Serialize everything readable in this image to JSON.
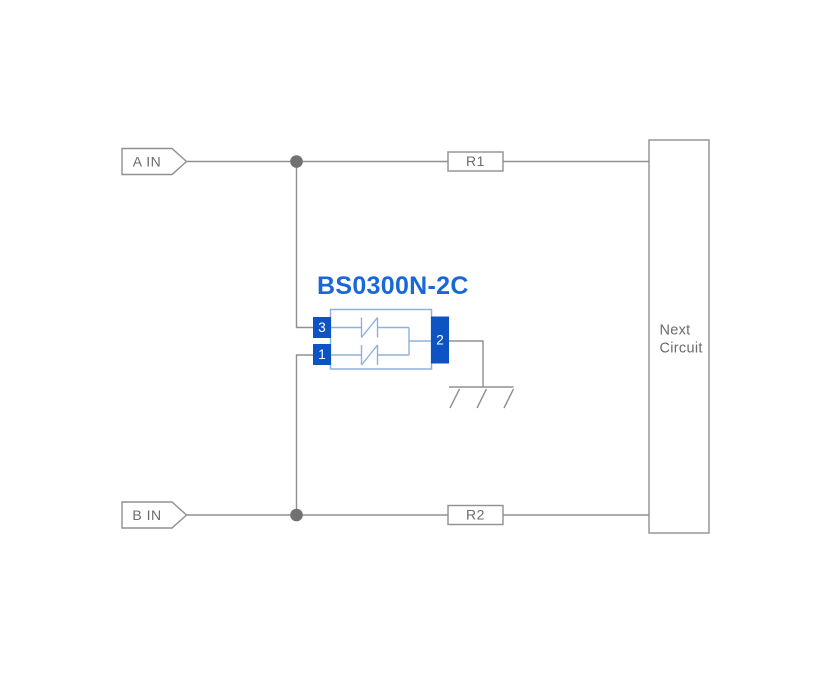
{
  "labels": {
    "input_a": "A IN",
    "input_b": "B IN",
    "resistor_1": "R1",
    "resistor_2": "R2",
    "next_circuit_line1": "Next",
    "next_circuit_line2": "Circuit",
    "component_title": "BS0300N-2C",
    "pin_3": "3",
    "pin_1": "1",
    "pin_2": "2"
  },
  "icons": {
    "junction": "junction-dot",
    "ground": "chassis-ground-symbol",
    "diode": "bidirectional-tvs-diode"
  },
  "colors": {
    "background": "#ffffff",
    "box_fill": "#ffffff",
    "wire_gray": "#909090",
    "junction_gray": "#717171",
    "text_gray": "#6b6b6b",
    "pin_blue": "#0d53c4",
    "light_blue": "#8fb0de",
    "title_blue": "#1a68d7"
  }
}
